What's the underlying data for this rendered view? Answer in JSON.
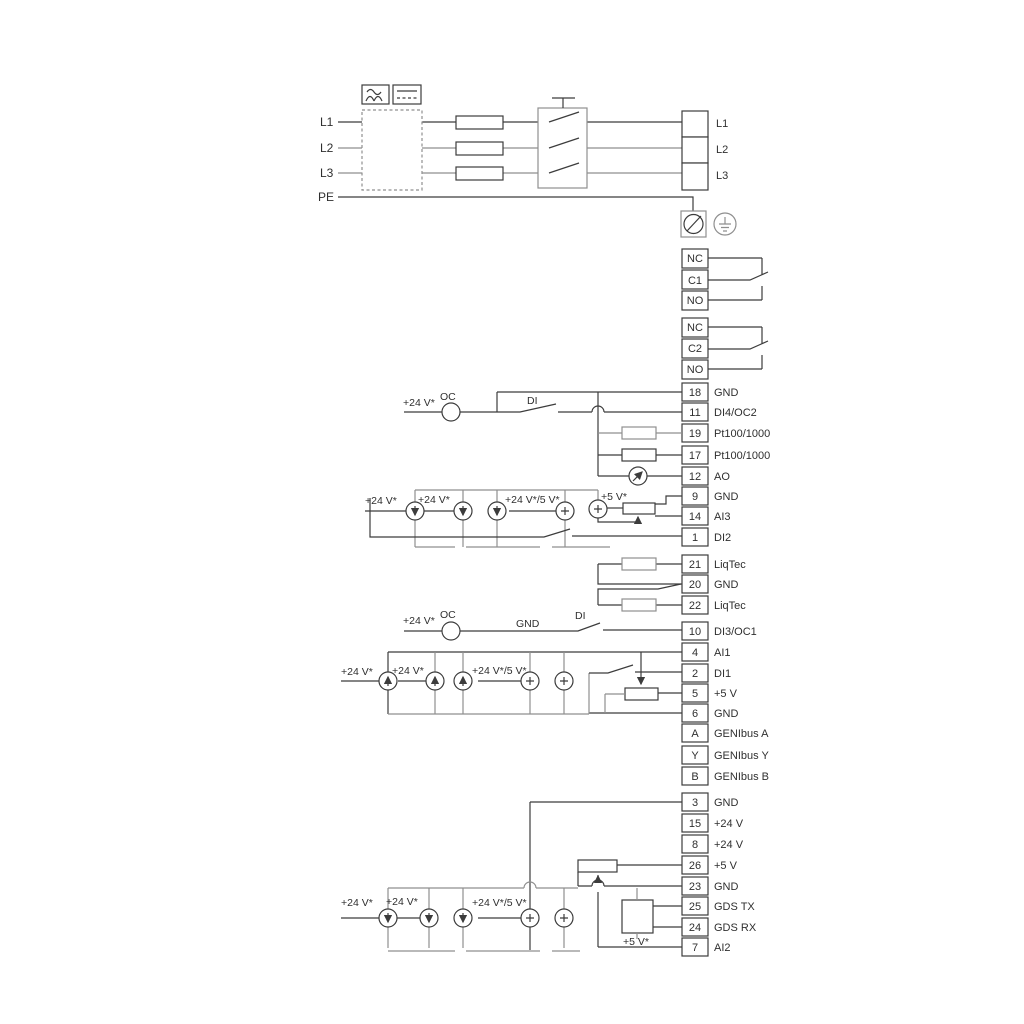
{
  "power": {
    "inputs": [
      "L1",
      "L2",
      "L3",
      "PE"
    ],
    "mains_terminals": [
      "L1",
      "L2",
      "L3"
    ]
  },
  "relays": [
    {
      "terminals": [
        "NC",
        "C1",
        "NO"
      ]
    },
    {
      "terminals": [
        "NC",
        "C2",
        "NO"
      ]
    }
  ],
  "io_terminals": [
    {
      "id": "18",
      "label": "GND"
    },
    {
      "id": "11",
      "label": "DI4/OC2"
    },
    {
      "id": "19",
      "label": "Pt100/1000"
    },
    {
      "id": "17",
      "label": "Pt100/1000"
    },
    {
      "id": "12",
      "label": "AO"
    },
    {
      "id": "9",
      "label": "GND"
    },
    {
      "id": "14",
      "label": "AI3"
    },
    {
      "id": "1",
      "label": "DI2"
    },
    {
      "id": "21",
      "label": "LiqTec"
    },
    {
      "id": "20",
      "label": "GND"
    },
    {
      "id": "22",
      "label": "LiqTec"
    },
    {
      "id": "10",
      "label": "DI3/OC1"
    },
    {
      "id": "4",
      "label": "AI1"
    },
    {
      "id": "2",
      "label": "DI1"
    },
    {
      "id": "5",
      "label": "+5 V"
    },
    {
      "id": "6",
      "label": "GND"
    },
    {
      "id": "A",
      "label": "GENIbus A"
    },
    {
      "id": "Y",
      "label": "GENIbus Y"
    },
    {
      "id": "B",
      "label": "GENIbus B"
    },
    {
      "id": "3",
      "label": "GND"
    },
    {
      "id": "15",
      "label": "+24 V"
    },
    {
      "id": "8",
      "label": "+24 V"
    },
    {
      "id": "26",
      "label": "+5 V"
    },
    {
      "id": "23",
      "label": "GND"
    },
    {
      "id": "25",
      "label": "GDS TX"
    },
    {
      "id": "24",
      "label": "GDS RX"
    },
    {
      "id": "7",
      "label": "AI2"
    }
  ],
  "annotations": {
    "v24": "+24 V*",
    "v24_5": "+24 V*/5 V*",
    "v5s": "+5 V*",
    "oc": "OC",
    "di": "DI",
    "gnd": "GND"
  },
  "symbols": {
    "rectifier": "ac-waveform-icon",
    "dc": "dc-lines-icon",
    "fuse": "fuse-icon",
    "disconnect": "main-switch-icon",
    "screw_terminal": "screw-terminal-icon",
    "earth": "protective-earth-icon",
    "current_source": "current-source-icon",
    "potentiometer": "potentiometer-icon",
    "analog_meter": "analog-output-meter-icon",
    "sensor_box": "gds-sensor-icon"
  },
  "colors": {
    "wire_dark": "#3c3c3c",
    "wire_grey": "#8f8f8f",
    "text": "#2f2f2f",
    "background": "#ffffff"
  }
}
